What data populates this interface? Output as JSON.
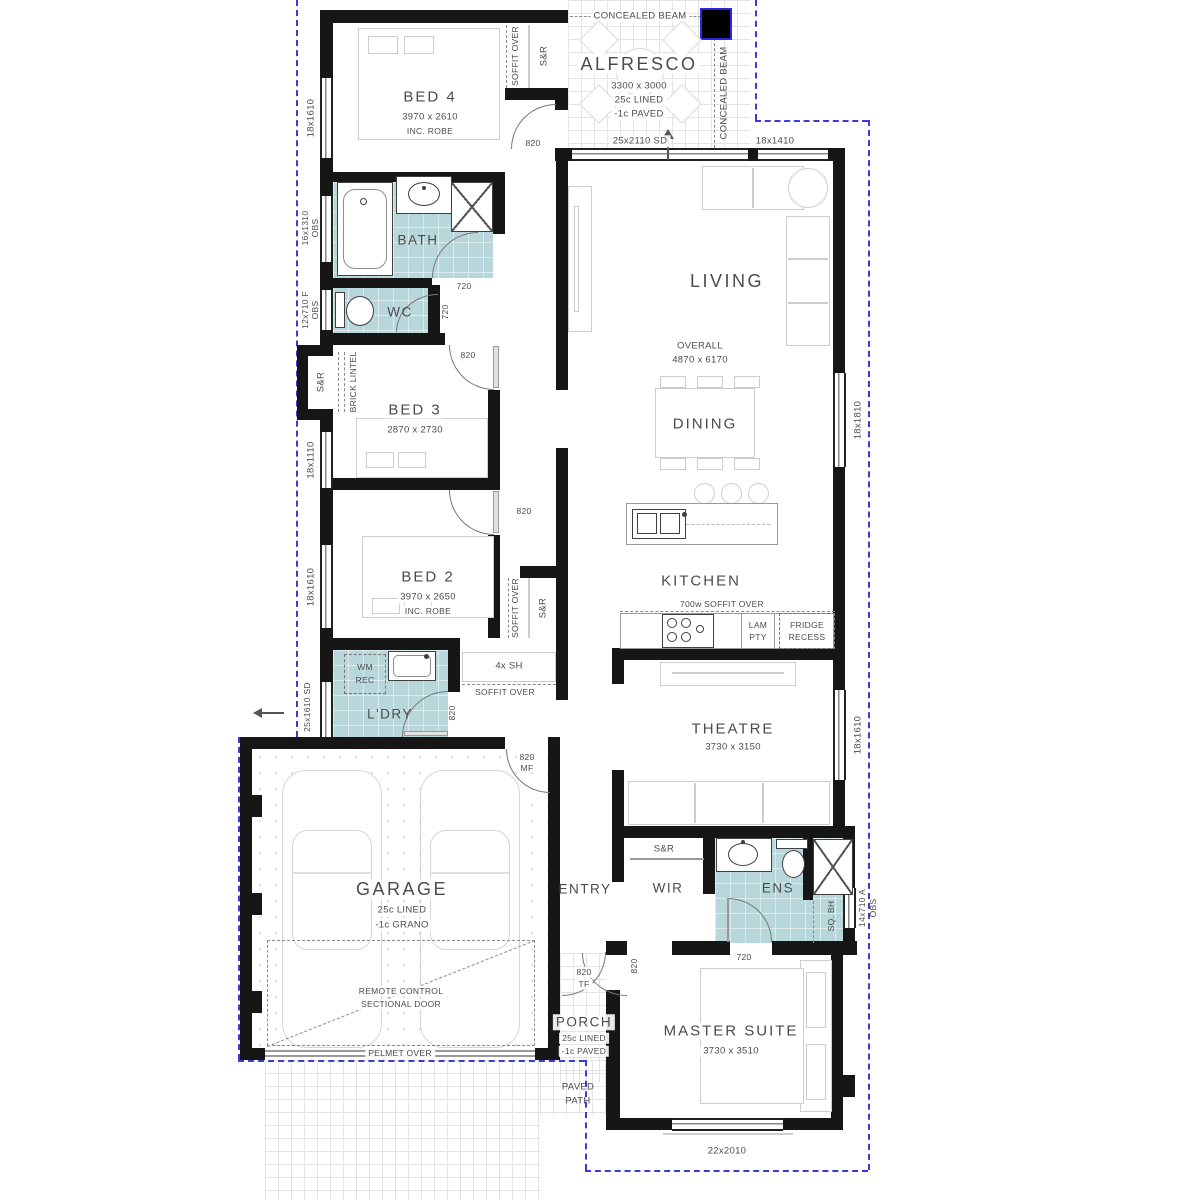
{
  "rooms": {
    "alfresco": {
      "name": "ALFRESCO",
      "dims": "3300 x 3000",
      "note1": "25c LINED",
      "note2": "-1c PAVED"
    },
    "bed4": {
      "name": "BED 4",
      "dims": "3970 x 2610",
      "note": "INC. ROBE"
    },
    "bath": {
      "name": "BATH"
    },
    "wc": {
      "name": "WC"
    },
    "bed3": {
      "name": "BED 3",
      "dims": "2870 x 2730"
    },
    "bed2": {
      "name": "BED 2",
      "dims": "3970 x 2650",
      "note": "INC. ROBE"
    },
    "living": {
      "name": "LIVING"
    },
    "dining": {
      "name": "DINING"
    },
    "kitchen": {
      "name": "KITCHEN"
    },
    "ldry": {
      "name": "L'DRY"
    },
    "theatre": {
      "name": "THEATRE",
      "dims": "3730 x 3150"
    },
    "garage": {
      "name": "GARAGE",
      "note1": "25c LINED",
      "note2": "-1c GRANO"
    },
    "entry": {
      "name": "ENTRY"
    },
    "wir": {
      "name": "WIR"
    },
    "ens": {
      "name": "ENS"
    },
    "porch": {
      "name": "PORCH",
      "note1": "25c LINED",
      "note2": "-1c PAVED"
    },
    "master": {
      "name": "MASTER SUITE",
      "dims": "3730 x 3510"
    }
  },
  "overall": {
    "label": "OVERALL",
    "dims": "4870 x 6170"
  },
  "windows": {
    "left": [
      {
        "t": "18x1610"
      },
      {
        "t": "16x1310",
        "t2": "OBS"
      },
      {
        "t": "12x710 F",
        "t2": "OBS"
      },
      {
        "t": "18x1110"
      },
      {
        "t": "18x1610"
      },
      {
        "t": "25x1610 SD"
      }
    ],
    "top": [
      {
        "t": "25x2110 SD"
      },
      {
        "t": "18x1410"
      }
    ],
    "right": [
      {
        "t": "18x1810"
      },
      {
        "t": "18x1610"
      },
      {
        "t": "14x710 A",
        "t2": "OBS"
      }
    ],
    "bottom": [
      {
        "t": "22x2010"
      }
    ]
  },
  "doors": {
    "d820": "820",
    "d720": "720",
    "mf": {
      "n": "820",
      "s": "MF"
    },
    "tf": {
      "n": "820",
      "s": "TF"
    }
  },
  "labels": {
    "concealed_beam": "CONCEALED BEAM",
    "soffit_over": "SOFFIT OVER",
    "sr": "S&R",
    "brick_lintel": "BRICK LINTEL",
    "soffit_700": "700w SOFFIT OVER",
    "lam1": "LAM",
    "lam2": "PTY",
    "fridge1": "FRIDGE",
    "fridge2": "RECESS",
    "wm1": "WM",
    "wm2": "REC",
    "shelves": "4x SH",
    "sq_bh": "SQ. BH",
    "remote1": "REMOTE CONTROL",
    "remote2": "SECTIONAL DOOR",
    "pelmet": "PELMET OVER",
    "paved1": "PAVED",
    "paved2": "PATH"
  },
  "colors": {
    "wall": "#161616",
    "wet_area": "#b7d7db",
    "boundary": "#3b3bd8"
  }
}
